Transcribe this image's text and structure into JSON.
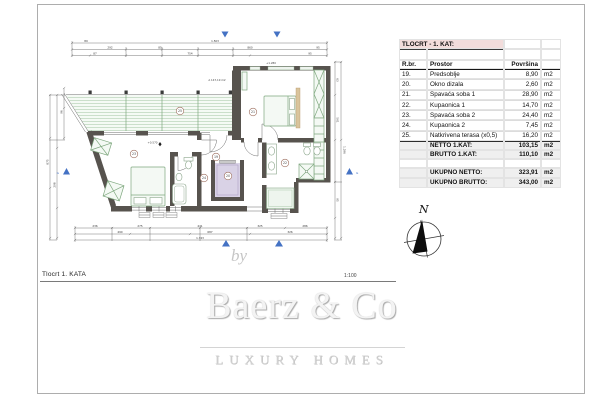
{
  "page": {
    "title": "Tlocrt 1. KATA",
    "scale": "1:100"
  },
  "compass": {
    "north": "N"
  },
  "logo": {
    "by": "by",
    "name": "Baerz & Co",
    "tagline": "LUXURY HOMES"
  },
  "table": {
    "title": "TLOCRT - 1. KAT:",
    "columns": [
      "R.br.",
      "Prostor",
      "Površina"
    ],
    "unit": "m2",
    "rows": [
      {
        "num": "19.",
        "name": "Predsoblje",
        "area": "8,90"
      },
      {
        "num": "20.",
        "name": "Okno dizala",
        "area": "2,60"
      },
      {
        "num": "21.",
        "name": "Spavaća soba 1",
        "area": "28,90"
      },
      {
        "num": "22.",
        "name": "Kupaonica 1",
        "area": "14,70"
      },
      {
        "num": "23.",
        "name": "Spavaća soba 2",
        "area": "24,40"
      },
      {
        "num": "24.",
        "name": "Kupaonica 2",
        "area": "7,45"
      },
      {
        "num": "25.",
        "name": "Natkrivena terasa (x0,5)",
        "area": "16,20"
      }
    ],
    "totals": [
      {
        "label": "NETTO 1.KAT:",
        "area": "103,15"
      },
      {
        "label": "BRUTTO 1.KAT:",
        "area": "110,10"
      }
    ],
    "grand_totals": [
      {
        "label": "UKUPNO NETTO:",
        "area": "323,91"
      },
      {
        "label": "UKUPNO BRUTTO:",
        "area": "343,00"
      }
    ]
  },
  "plan": {
    "area_label": "A 147,19 m2",
    "levels": [
      "+1.280",
      "+0.570"
    ],
    "rooms": [
      "25",
      "21",
      "19",
      "20",
      "22",
      "23",
      "24"
    ],
    "section_letter": "G",
    "dims": {
      "top": [
        "89",
        "1.503",
        "292",
        "85",
        "860",
        "95",
        "87",
        "754",
        "95"
      ],
      "bottom": [
        "236",
        "275",
        "441",
        "325",
        "286",
        "490",
        "687",
        "326",
        "1.743"
      ],
      "left": [
        "875",
        "96",
        "298"
      ],
      "right": [
        "63",
        "501",
        "95",
        "1.296"
      ]
    }
  },
  "colors": {
    "accent_pink": "#f2dcdb",
    "wall_gray": "#57534e",
    "furniture_green": "#7fa87f",
    "terrace_hatch_green": "#a9c9a9",
    "elevator_purple": "#d9d2e6",
    "marker_blue": "#4472c4",
    "logo_gray": "#d6d6d6",
    "total_row_gray": "#efefef"
  }
}
